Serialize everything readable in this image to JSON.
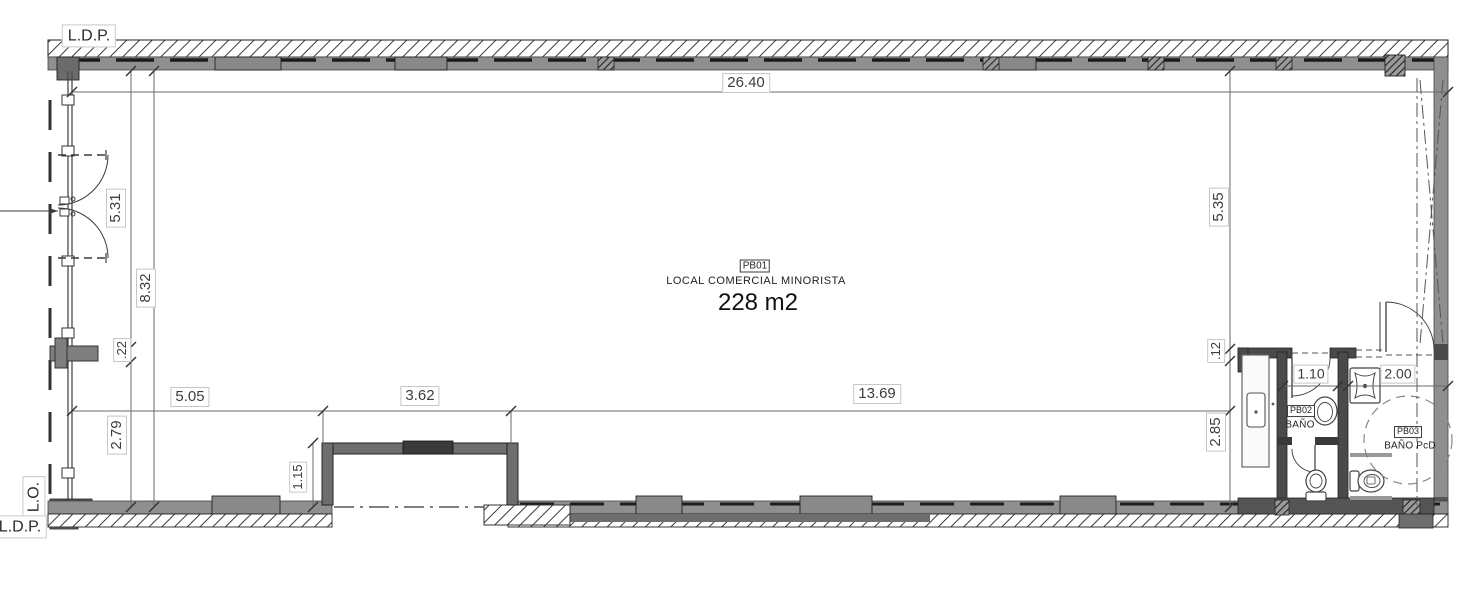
{
  "labels": {
    "ldp_top": "L.D.P.",
    "lo": "L.O.",
    "ldp_bottom": "L.D.P."
  },
  "room_main": {
    "code": "PB01",
    "name": "LOCAL COMERCIAL MINORISTA",
    "area": "228 m2"
  },
  "room_bath": {
    "code": "PB02",
    "name": "BAÑO"
  },
  "room_bath_acc": {
    "code": "PB03",
    "name": "BAÑO PcD"
  },
  "dims": {
    "total_width": "26.40",
    "left_door": "5.31",
    "left_total": "8.32",
    "stub": ".22",
    "left_lower": "2.79",
    "seg_a": "5.05",
    "recess_w": "3.62",
    "recess_d": "1.15",
    "seg_b": "13.69",
    "right_upper": "5.35",
    "wall_t": ".12",
    "right_lower": "2.85",
    "bath_w": "1.10",
    "bath_acc_w": "2.00"
  }
}
